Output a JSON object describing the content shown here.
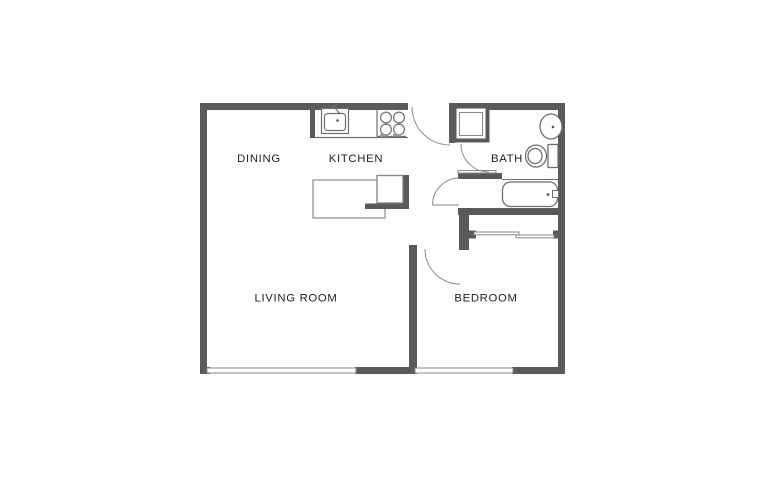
{
  "page": {
    "type": "apartment-floor-plan",
    "background": "#ffffff"
  },
  "colors": {
    "wall": "#5a5a5a",
    "thin_line": "#8a8a8a",
    "fixture": "#6f6f6f",
    "text": "#1d1d1d",
    "fill": "#ffffff"
  },
  "rooms": [
    {
      "id": "dining",
      "label": "DINING"
    },
    {
      "id": "kitchen",
      "label": "KITCHEN"
    },
    {
      "id": "bath",
      "label": "BATH"
    },
    {
      "id": "living-room",
      "label": "LIVING ROOM"
    },
    {
      "id": "bedroom",
      "label": "BEDROOM"
    }
  ],
  "fixtures": [
    "kitchen-sink",
    "stove-burners",
    "refrigerator",
    "kitchen-island-counter",
    "shower-stall",
    "bath-sink",
    "toilet",
    "bathtub",
    "closet-sliding-doors",
    "entry-door-swing",
    "bath-door-swing",
    "closet-door-swing",
    "bedroom-door-swing",
    "living-room-window",
    "bedroom-window"
  ]
}
